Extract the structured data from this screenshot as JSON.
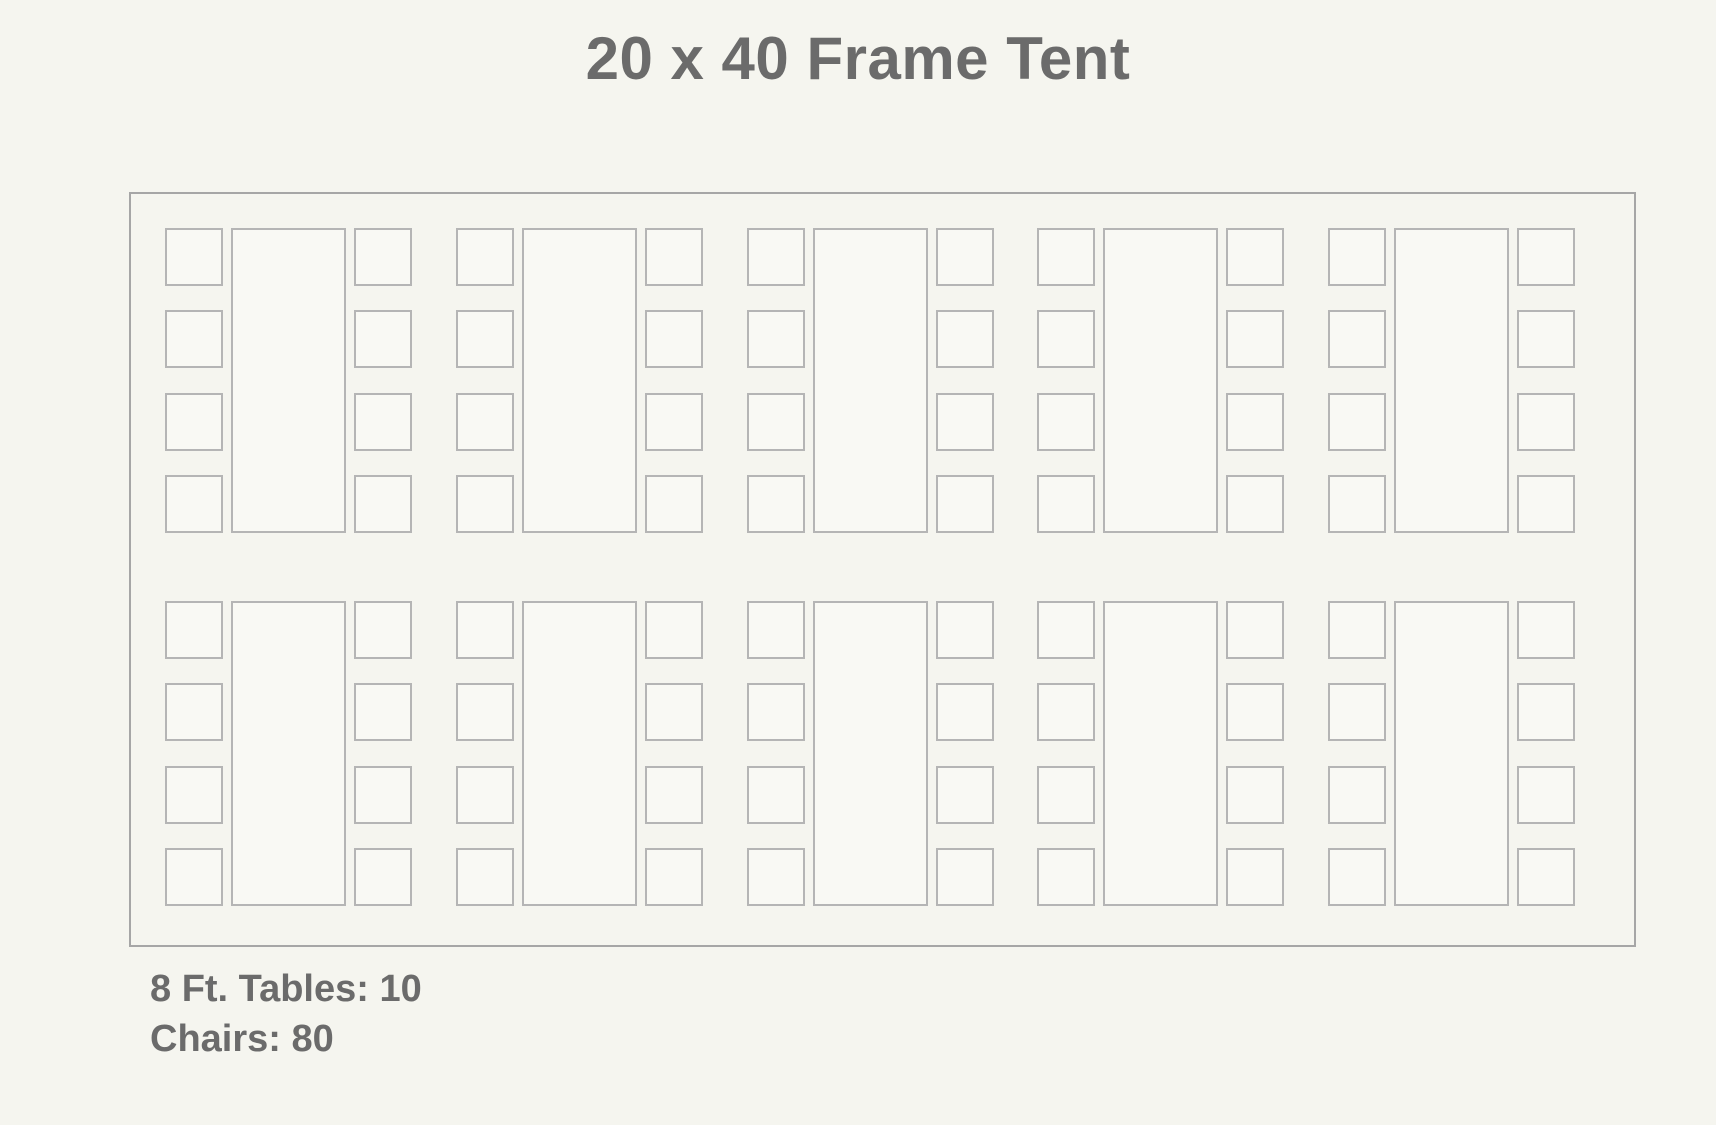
{
  "title": "20 x 40 Frame Tent",
  "legend": {
    "tables_label": "8 Ft. Tables: 10",
    "chairs_label": "Chairs: 80"
  },
  "layout": {
    "rows": 2,
    "tables_per_row": 5,
    "chairs_per_side": 4,
    "total_tables": 10,
    "total_chairs": 80,
    "table_type": "8 Ft. banquet table",
    "tent_type": "20 x 40 Frame Tent"
  },
  "colors": {
    "background": "#f5f5ef",
    "shape_fill": "#f9f9f4",
    "shape_border": "#b5b5b5",
    "tent_border": "#a6a6a6",
    "text": "#6b6b6b"
  }
}
